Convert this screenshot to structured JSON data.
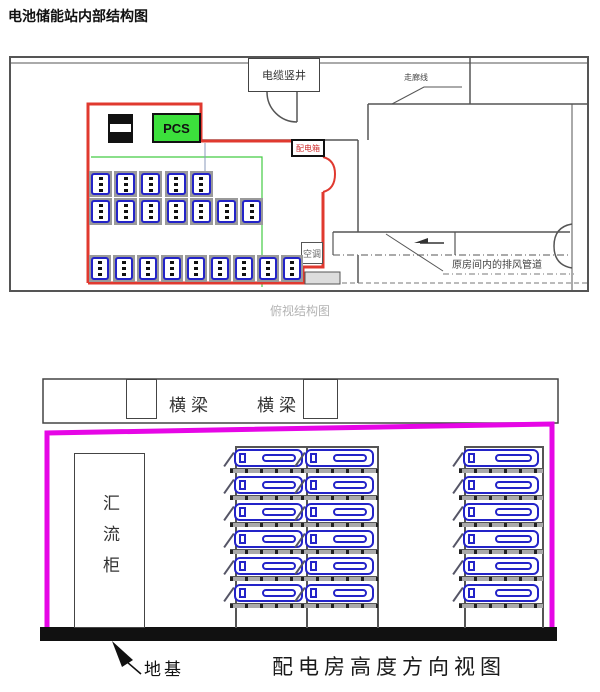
{
  "title": "电池储能站内部结构图",
  "colors": {
    "battery_room_outline_red": "#e0392f",
    "power_room_outline_magenta": "#e606e6",
    "pcs_green": "#3ce03c",
    "rack_blue": "#2323c8",
    "wall_gray": "#555555",
    "caption_gray": "#b3b3b3"
  },
  "top_view": {
    "caption": "俯视结构图",
    "cable_shaft_label": "电缆竖井",
    "corridor_label": "走廊线",
    "pcs_label": "PCS",
    "distribution_box_label": "配电箱",
    "air_conditioner_label": "空调",
    "exhaust_duct_label": "原房间内的排风管道",
    "battery_rack_rows": [
      5,
      7,
      9
    ]
  },
  "side_view": {
    "caption": "配电房高度方向视图",
    "beam_labels": [
      "横梁",
      "横梁"
    ],
    "bus_cabinet_label": "汇流柜",
    "foundation_label": "地基",
    "rack_shelf_count": 6,
    "rack_bay_groups": [
      2,
      1
    ]
  }
}
